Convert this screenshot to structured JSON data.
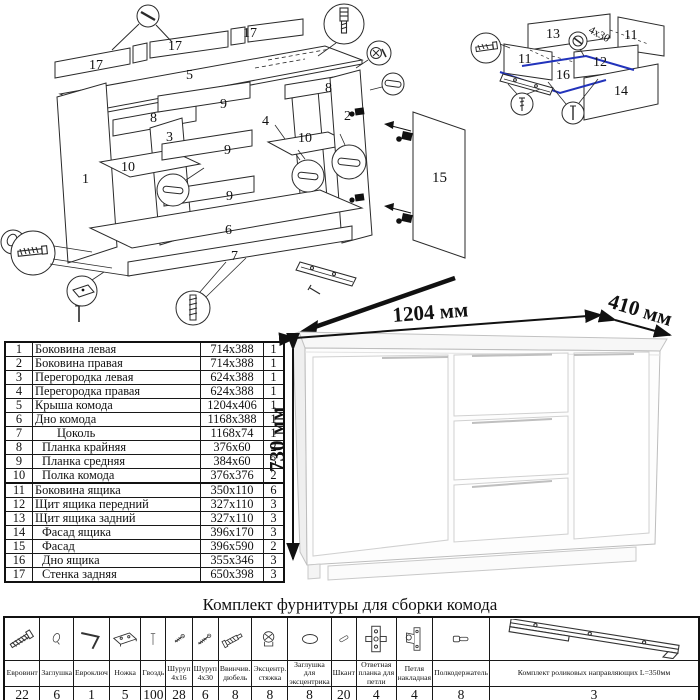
{
  "page": {
    "bg": "#ffffff",
    "line_color": "#222222",
    "accent_blue": "#2233bb"
  },
  "product": {
    "width_label": "1204 мм",
    "depth_label": "410 мм",
    "height_label": "730 мм"
  },
  "assembly": {
    "labels": {
      "back1": "17",
      "back2": "17",
      "back3": "17",
      "top": "5",
      "plank_left": "8",
      "plank_right": "8",
      "rail1": "9",
      "rail2": "9",
      "rail3": "9",
      "side_left": "1",
      "side_right": "2",
      "part_left": "3",
      "part_right": "4",
      "shelf_left": "10",
      "shelf_right": "10",
      "bottom": "6",
      "plinth": "7",
      "door": "15"
    }
  },
  "drawer": {
    "labels": {
      "back": "13",
      "side_left": "11",
      "side_right": "11",
      "front": "12",
      "facade": "14",
      "bottom": "16"
    },
    "screw_note": "4x30"
  },
  "parts_table": {
    "rows": [
      {
        "num": "1",
        "name": "Боковина левая",
        "size": "714x388",
        "qty": "1",
        "indent": 0,
        "sect": false
      },
      {
        "num": "2",
        "name": "Боковина правая",
        "size": "714x388",
        "qty": "1",
        "indent": 0,
        "sect": false
      },
      {
        "num": "3",
        "name": "Перегородка левая",
        "size": "624x388",
        "qty": "1",
        "indent": 0,
        "sect": false
      },
      {
        "num": "4",
        "name": "Перегородка правая",
        "size": "624x388",
        "qty": "1",
        "indent": 0,
        "sect": false
      },
      {
        "num": "5",
        "name": "Крыша комода",
        "size": "1204x406",
        "qty": "1",
        "indent": 0,
        "sect": false
      },
      {
        "num": "6",
        "name": "Дно комода",
        "size": "1168x388",
        "qty": "1",
        "indent": 0,
        "sect": false
      },
      {
        "num": "7",
        "name": "Цоколь",
        "size": "1168x74",
        "qty": "1",
        "indent": 2,
        "sect": false
      },
      {
        "num": "8",
        "name": "Планка крайняя",
        "size": "376x60",
        "qty": "2",
        "indent": 1,
        "sect": false
      },
      {
        "num": "9",
        "name": "Планка средняя",
        "size": "384x60",
        "qty": "3",
        "indent": 1,
        "sect": false
      },
      {
        "num": "10",
        "name": "Полка комода",
        "size": "376x376",
        "qty": "2",
        "indent": 1,
        "sect": false
      },
      {
        "num": "11",
        "name": "Боковина ящика",
        "size": "350x110",
        "qty": "6",
        "indent": 0,
        "sect": true
      },
      {
        "num": "12",
        "name": "Щит ящика передний",
        "size": "327x110",
        "qty": "3",
        "indent": 0,
        "sect": false
      },
      {
        "num": "13",
        "name": "Щит ящика задний",
        "size": "327x110",
        "qty": "3",
        "indent": 0,
        "sect": false
      },
      {
        "num": "14",
        "name": "Фасад ящика",
        "size": "396x170",
        "qty": "3",
        "indent": 1,
        "sect": false
      },
      {
        "num": "15",
        "name": "Фасад",
        "size": "396x590",
        "qty": "2",
        "indent": 1,
        "sect": false
      },
      {
        "num": "16",
        "name": "Дно ящика",
        "size": "355x346",
        "qty": "3",
        "indent": 1,
        "sect": false
      },
      {
        "num": "17",
        "name": "Стенка задняя",
        "size": "650x398",
        "qty": "3",
        "indent": 1,
        "sect": false
      }
    ]
  },
  "hardware": {
    "title": "Комплект фурнитуры для сборки комода",
    "items": [
      {
        "name": "Евровинт",
        "qty": "22",
        "icon": "euro-screw"
      },
      {
        "name": "Заглушка",
        "qty": "6",
        "icon": "cap"
      },
      {
        "name": "Евроключ",
        "qty": "1",
        "icon": "hex-key"
      },
      {
        "name": "Ножка",
        "qty": "5",
        "icon": "foot"
      },
      {
        "name": "Гвоздь",
        "qty": "100",
        "icon": "nail"
      },
      {
        "name": "Шуруп 4x16",
        "qty": "28",
        "icon": "screw-small"
      },
      {
        "name": "Шуруп 4x30",
        "qty": "6",
        "icon": "screw-large"
      },
      {
        "name": "Ввинчив. дюбель",
        "qty": "8",
        "icon": "screw-dowel"
      },
      {
        "name": "Эксцентр. стяжка",
        "qty": "8",
        "icon": "cam-lock"
      },
      {
        "name": "Заглушка для эксцентрика",
        "qty": "8",
        "icon": "cam-cap"
      },
      {
        "name": "Шкант",
        "qty": "20",
        "icon": "dowel"
      },
      {
        "name": "Ответная планка для петли",
        "qty": "4",
        "icon": "hinge-plate"
      },
      {
        "name": "Петля накладная",
        "qty": "4",
        "icon": "hinge"
      },
      {
        "name": "Полкодержатель",
        "qty": "8",
        "icon": "shelf-pin"
      },
      {
        "name": "Комплект роликовых направляющих L=350мм",
        "qty": "3",
        "icon": "drawer-slides"
      }
    ]
  }
}
